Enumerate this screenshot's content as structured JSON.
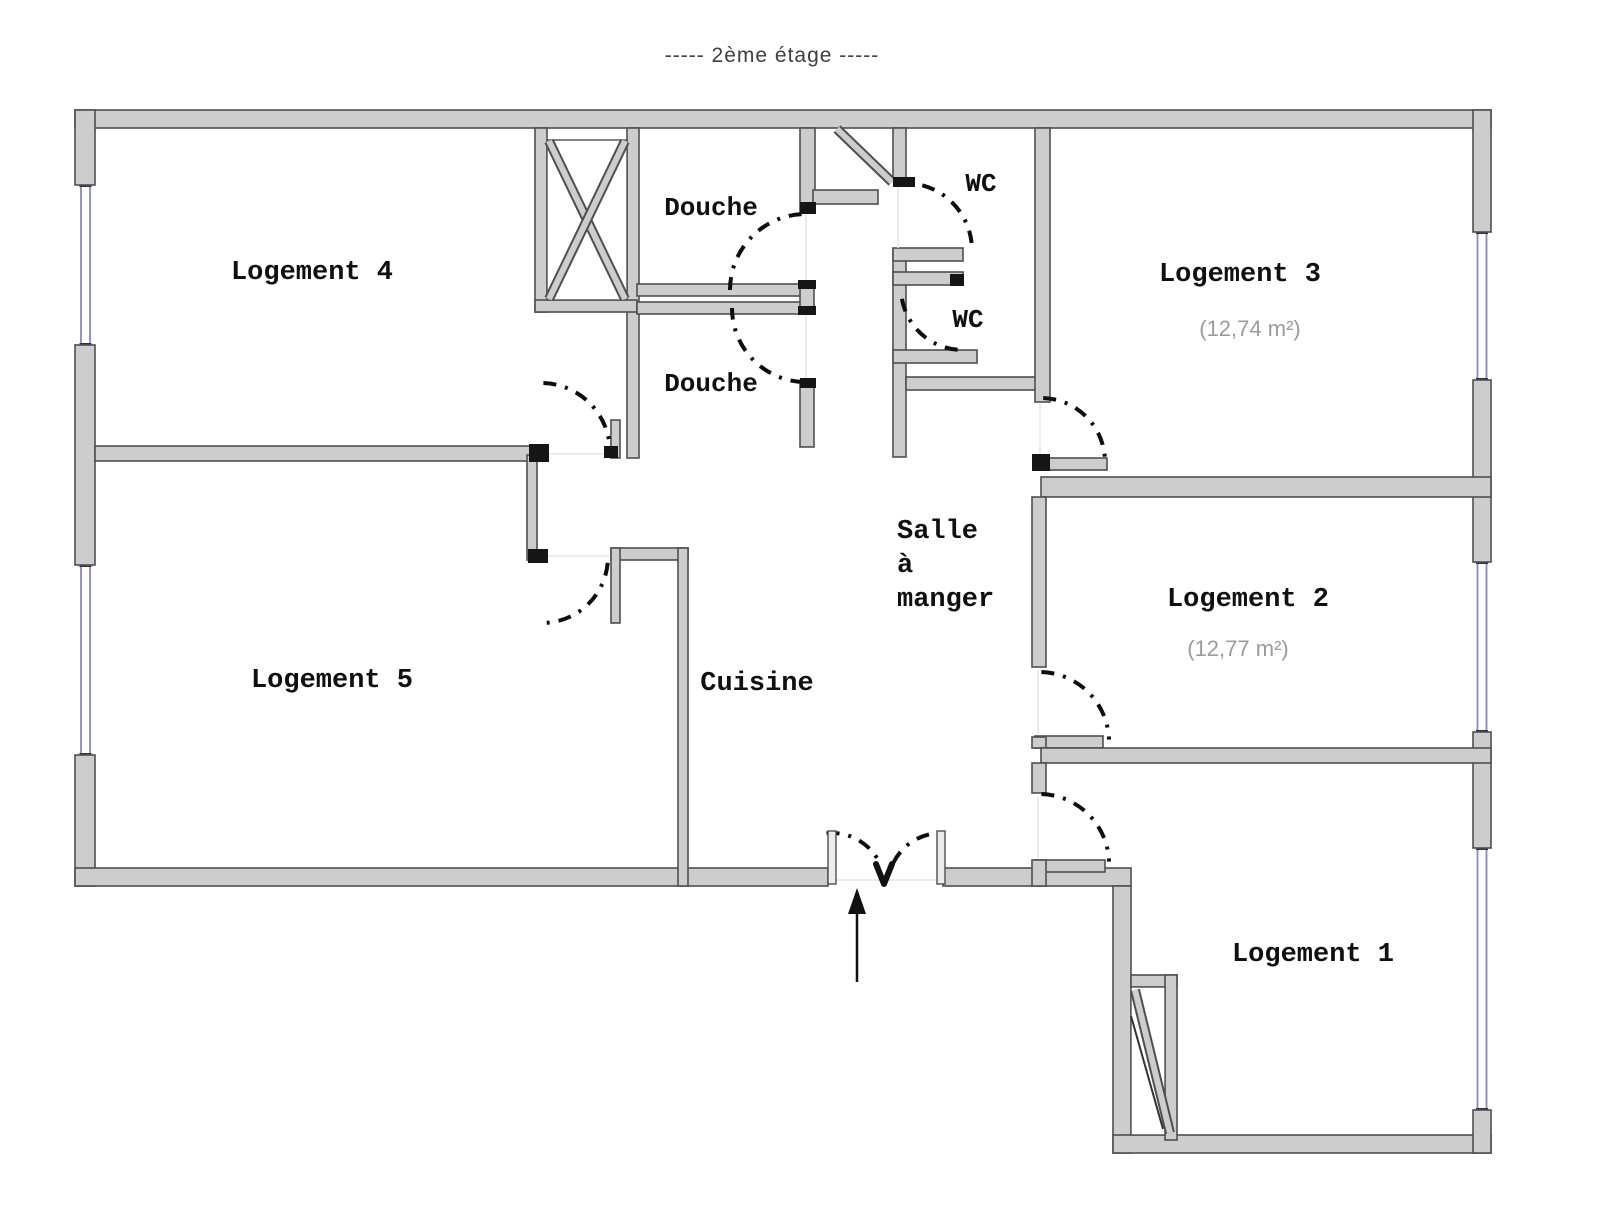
{
  "title": "-----   2ème étage   -----",
  "floor_label": "2ème étage",
  "colors": {
    "wall_fill": "#cdcdcd",
    "wall_stroke": "#4f4f4f",
    "door_arc": "#0d0d0d",
    "window_glass": "#8289cc",
    "label_text": "#101010",
    "area_text": "#9b9b9b",
    "title_text": "#3f3f3f",
    "light_line": "#e6e6e6",
    "background": "#ffffff"
  },
  "rooms": [
    {
      "id": "logement-4",
      "label": "Logement 4",
      "x": 312,
      "y": 279,
      "size": 27
    },
    {
      "id": "logement-5",
      "label": "Logement 5",
      "x": 332,
      "y": 687,
      "size": 27
    },
    {
      "id": "logement-3",
      "label": "Logement 3",
      "x": 1240,
      "y": 281,
      "size": 27,
      "area": "(12,74 m²)",
      "ax": 1250,
      "ay": 336
    },
    {
      "id": "logement-2",
      "label": "Logement 2",
      "x": 1248,
      "y": 606,
      "size": 27,
      "area": "(12,77 m²)",
      "ax": 1238,
      "ay": 656
    },
    {
      "id": "logement-1",
      "label": "Logement 1",
      "x": 1313,
      "y": 961,
      "size": 27
    },
    {
      "id": "cuisine",
      "label": "Cuisine",
      "x": 757,
      "y": 690,
      "size": 27
    },
    {
      "id": "salle-a-manger",
      "label": "Salle à manger",
      "x": 897,
      "y": 538,
      "size": 27,
      "anchor": "start",
      "lines": [
        "Salle",
        "à",
        "manger"
      ],
      "lh": 34
    },
    {
      "id": "douche-1",
      "label": "Douche",
      "x": 711,
      "y": 215,
      "size": 26
    },
    {
      "id": "douche-2",
      "label": "Douche",
      "x": 711,
      "y": 391,
      "size": 26
    },
    {
      "id": "wc-1",
      "label": "WC",
      "x": 981,
      "y": 191,
      "size": 26
    },
    {
      "id": "wc-2",
      "label": "WC",
      "x": 968,
      "y": 327,
      "size": 26
    }
  ],
  "walls": [
    [
      75,
      110,
      1416,
      18
    ],
    [
      75,
      110,
      20,
      75
    ],
    [
      75,
      345,
      20,
      220
    ],
    [
      75,
      755,
      20,
      131
    ],
    [
      75,
      868,
      753,
      18
    ],
    [
      943,
      868,
      188,
      18
    ],
    [
      1113,
      886,
      18,
      267
    ],
    [
      1113,
      1135,
      378,
      18
    ],
    [
      1473,
      110,
      18,
      122
    ],
    [
      1473,
      380,
      18,
      182
    ],
    [
      1473,
      732,
      18,
      116
    ],
    [
      1473,
      1110,
      18,
      43
    ],
    [
      95,
      446,
      443,
      15
    ],
    [
      535,
      128,
      12,
      184
    ],
    [
      627,
      128,
      12,
      330
    ],
    [
      535,
      300,
      102,
      12
    ],
    [
      637,
      284,
      175,
      12
    ],
    [
      637,
      302,
      165,
      12
    ],
    [
      800,
      128,
      15,
      84
    ],
    [
      800,
      288,
      14,
      22
    ],
    [
      800,
      383,
      14,
      64
    ],
    [
      813,
      190,
      65,
      14
    ],
    [
      893,
      128,
      13,
      52
    ],
    [
      893,
      250,
      13,
      207
    ],
    [
      893,
      248,
      70,
      13
    ],
    [
      893,
      272,
      70,
      13
    ],
    [
      893,
      350,
      84,
      13
    ],
    [
      906,
      377,
      136,
      13
    ],
    [
      1035,
      128,
      15,
      274
    ],
    [
      1037,
      458,
      70,
      12
    ],
    [
      1041,
      477,
      450,
      20
    ],
    [
      1032,
      497,
      14,
      170
    ],
    [
      1035,
      736,
      68,
      12
    ],
    [
      1032,
      737,
      14,
      11
    ],
    [
      1041,
      748,
      450,
      15
    ],
    [
      1032,
      763,
      14,
      30
    ],
    [
      1035,
      860,
      70,
      12
    ],
    [
      1032,
      860,
      14,
      26
    ],
    [
      611,
      548,
      77,
      12
    ],
    [
      611,
      548,
      9,
      75
    ],
    [
      678,
      548,
      10,
      338
    ],
    [
      527,
      455,
      10,
      105
    ],
    [
      611,
      420,
      9,
      38
    ],
    [
      1131,
      975,
      46,
      12
    ],
    [
      1165,
      975,
      12,
      165
    ]
  ],
  "inner_boxes": [
    {
      "id": "shaft-inner",
      "x": 547,
      "y": 140,
      "w": 80,
      "h": 160
    },
    {
      "id": "stairs-inner",
      "x": 1131,
      "y": 987,
      "w": 34,
      "h": 148
    }
  ],
  "diagonals": [
    {
      "id": "shaft-cross-a",
      "x1": 549,
      "y1": 141,
      "x2": 625,
      "y2": 299,
      "style": "band"
    },
    {
      "id": "shaft-cross-b",
      "x1": 625,
      "y1": 141,
      "x2": 549,
      "y2": 299,
      "style": "band"
    },
    {
      "id": "vestibule-door-leaf",
      "x1": 837,
      "y1": 129,
      "x2": 892,
      "y2": 182,
      "style": "band"
    },
    {
      "id": "stairs-diagonal",
      "x1": 1135,
      "y1": 990,
      "x2": 1170,
      "y2": 1133,
      "style": "band"
    },
    {
      "id": "stairs-line",
      "x1": 1131,
      "y1": 1016,
      "x2": 1163,
      "y2": 1129,
      "style": "thin"
    }
  ],
  "doors": [
    {
      "id": "douche-1-door",
      "cx": 806,
      "cy": 290,
      "r": 76,
      "a1": 180,
      "a2": 268
    },
    {
      "id": "douche-2-door",
      "cx": 806,
      "cy": 308,
      "r": 74,
      "a1": 92,
      "a2": 180
    },
    {
      "id": "wc-1-door",
      "cx": 905,
      "cy": 250,
      "r": 67,
      "a1": -75,
      "a2": -6
    },
    {
      "id": "wc-2-door",
      "cx": 963,
      "cy": 288,
      "r": 62,
      "a1": 95,
      "a2": 178
    },
    {
      "id": "logement-4-door",
      "cx": 541,
      "cy": 452,
      "r": 69,
      "a1": 272,
      "a2": 357
    },
    {
      "id": "logement-5-door",
      "cx": 542,
      "cy": 557,
      "r": 66,
      "a1": 5,
      "a2": 87
    },
    {
      "id": "logement-3-door",
      "cx": 1041,
      "cy": 462,
      "r": 64,
      "a1": 272,
      "a2": 358
    },
    {
      "id": "logement-2-door",
      "cx": 1039,
      "cy": 742,
      "r": 70,
      "a1": 272,
      "a2": 358
    },
    {
      "id": "logement-1-door",
      "cx": 1039,
      "cy": 864,
      "r": 70,
      "a1": 272,
      "a2": 358
    },
    {
      "id": "entrance-door-left",
      "cx": 832,
      "cy": 886,
      "r": 53,
      "a1": 264,
      "a2": 334
    },
    {
      "id": "entrance-door-right",
      "cx": 941,
      "cy": 886,
      "r": 53,
      "a1": 206,
      "a2": 276
    }
  ],
  "windows": [
    {
      "id": "window-logement-4",
      "c": 85.5,
      "a": 185,
      "b": 345
    },
    {
      "id": "window-logement-5",
      "c": 85.5,
      "a": 565,
      "b": 755
    },
    {
      "id": "window-logement-3",
      "c": 1482,
      "a": 232,
      "b": 380
    },
    {
      "id": "window-logement-2",
      "c": 1482,
      "a": 562,
      "b": 732
    },
    {
      "id": "window-logement-1",
      "c": 1482,
      "a": 848,
      "b": 1110
    }
  ],
  "caps": [
    [
      529,
      444,
      20,
      18
    ],
    [
      528,
      549,
      20,
      14
    ],
    [
      893,
      177,
      22,
      10
    ],
    [
      950,
      274,
      14,
      12
    ],
    [
      800,
      202,
      16,
      12
    ],
    [
      798,
      280,
      18,
      9
    ],
    [
      798,
      306,
      18,
      9
    ],
    [
      800,
      378,
      16,
      10
    ],
    [
      604,
      446,
      14,
      12
    ],
    [
      1032,
      454,
      18,
      17
    ]
  ],
  "jambs": [
    [
      828,
      831,
      8,
      53
    ],
    [
      937,
      831,
      8,
      53
    ]
  ],
  "light_lines": [
    [
      836,
      880,
      937,
      880
    ],
    [
      806,
      214,
      806,
      286
    ],
    [
      806,
      312,
      806,
      381
    ],
    [
      898,
      182,
      898,
      248
    ],
    [
      1040,
      404,
      1040,
      456
    ],
    [
      1038,
      670,
      1038,
      734
    ],
    [
      1038,
      796,
      1038,
      858
    ],
    [
      540,
      454,
      609,
      454
    ],
    [
      539,
      556,
      609,
      556
    ]
  ],
  "entry_arrow": {
    "x": 857,
    "y1": 982,
    "y2": 902,
    "head": [
      [
        857,
        888
      ],
      [
        848,
        914
      ],
      [
        866,
        914
      ]
    ]
  },
  "v_mark": [
    [
      876,
      864
    ],
    [
      884,
      884
    ],
    [
      892,
      864
    ]
  ]
}
